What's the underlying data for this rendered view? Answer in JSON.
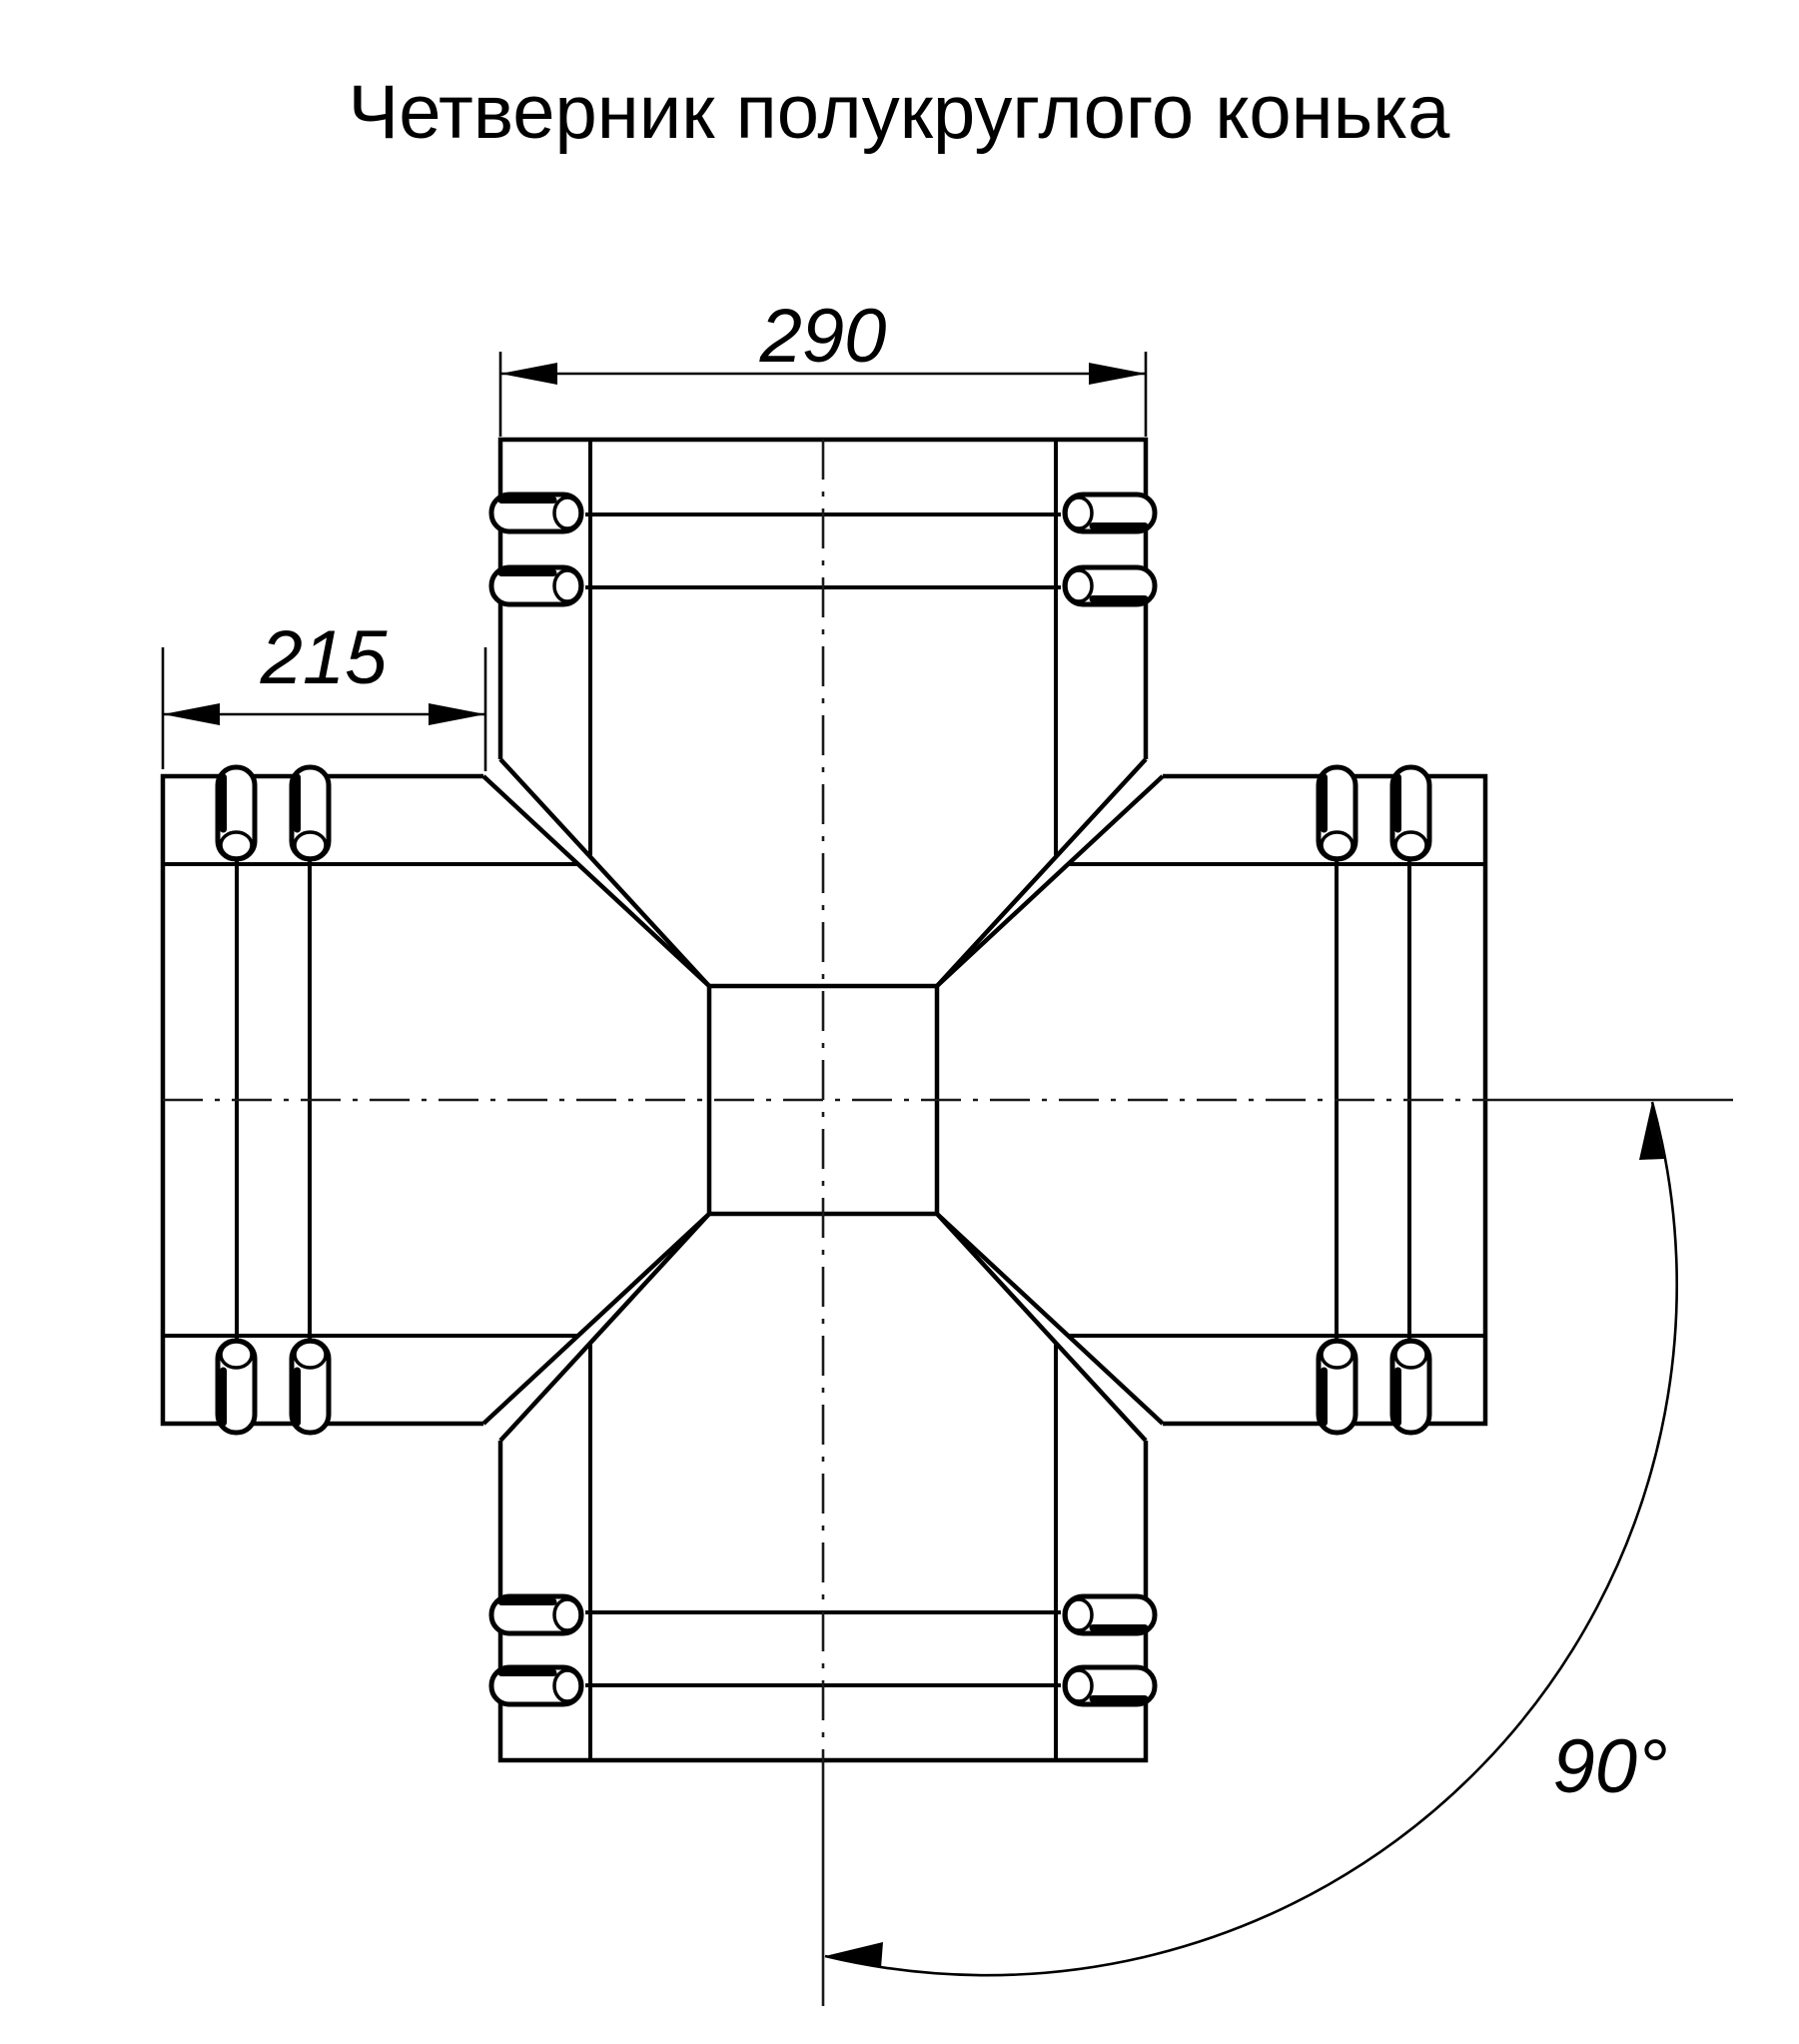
{
  "title": "Четверник полукруглого конька",
  "dimensions": {
    "top_width": "290",
    "side_length": "215",
    "angle": "90°"
  },
  "style": {
    "line_color": "#000000",
    "background_color": "#ffffff"
  }
}
